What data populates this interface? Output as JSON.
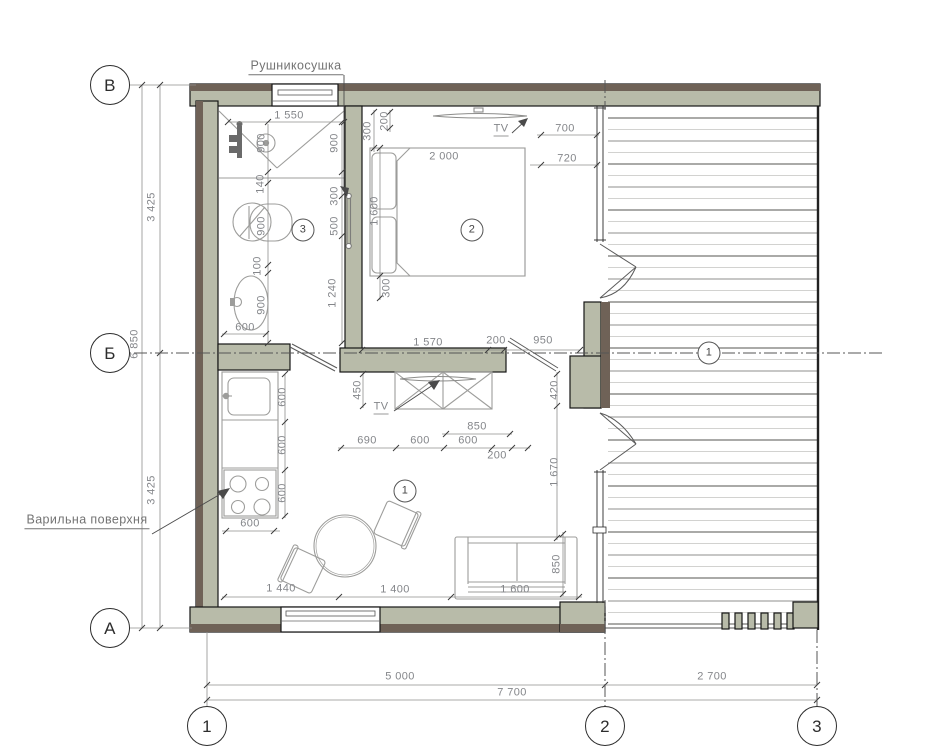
{
  "drawing": {
    "type": "floor-plan",
    "colors": {
      "wall_fill": "#b8bba9",
      "wall_band": "#6f6257",
      "outline": "#161616",
      "furniture_line": "#9d9d9b",
      "dim_text": "#84868a",
      "centerline": "#555555"
    },
    "leader_labels": {
      "towel_dryer": "Рушникосушка",
      "cooktop": "Варильна поверхня"
    },
    "axis_markers_left": [
      "В",
      "Б",
      "А"
    ],
    "axis_markers_bottom": [
      "1",
      "2",
      "3"
    ],
    "room_numbers": [
      "1",
      "2",
      "3"
    ],
    "overall_dimensions": {
      "left_segments": [
        "3 425",
        "3 425"
      ],
      "left_total": "6 850",
      "bottom_segments": [
        "5 000",
        "2 700"
      ],
      "bottom_total": "7 700"
    }
  },
  "annotations": [
    {
      "type": "axis",
      "text": "В",
      "x": 110,
      "y": 85,
      "name": "axis-row-v"
    },
    {
      "type": "axis",
      "text": "Б",
      "x": 110,
      "y": 353,
      "name": "axis-row-b"
    },
    {
      "type": "axis",
      "text": "А",
      "x": 110,
      "y": 628,
      "name": "axis-row-a"
    },
    {
      "type": "axis",
      "text": "1",
      "x": 207,
      "y": 726,
      "name": "axis-col-1"
    },
    {
      "type": "axis",
      "text": "2",
      "x": 605,
      "y": 726,
      "name": "axis-col-2"
    },
    {
      "type": "axis",
      "text": "3",
      "x": 817,
      "y": 726,
      "name": "axis-col-3"
    },
    {
      "type": "room",
      "text": "3",
      "x": 303,
      "y": 230,
      "name": "room-number-3"
    },
    {
      "type": "room",
      "text": "2",
      "x": 472,
      "y": 230,
      "name": "room-number-2"
    },
    {
      "type": "room",
      "text": "1",
      "x": 405,
      "y": 491,
      "name": "room-number-1"
    },
    {
      "type": "room",
      "text": "1",
      "x": 709,
      "y": 353,
      "name": "axis-ref-1"
    },
    {
      "type": "label",
      "text": "Рушникосушка",
      "x": 296,
      "y": 67,
      "name": "label-towel-dryer"
    },
    {
      "type": "label",
      "text": "Варильна поверхня",
      "x": 87,
      "y": 521,
      "name": "label-cooktop"
    },
    {
      "type": "tvlabel",
      "text": "TV",
      "x": 501,
      "y": 130,
      "name": "label-tv-bedroom"
    },
    {
      "type": "tvlabel",
      "text": "TV",
      "x": 381,
      "y": 408,
      "name": "label-tv-living"
    },
    {
      "type": "dim",
      "text": "1 550",
      "x": 289,
      "y": 116
    },
    {
      "type": "dim",
      "text": "600",
      "x": 245,
      "y": 328
    },
    {
      "type": "dim",
      "text": "2 000",
      "x": 444,
      "y": 157
    },
    {
      "type": "dim",
      "text": "700",
      "x": 565,
      "y": 129
    },
    {
      "type": "dim",
      "text": "720",
      "x": 567,
      "y": 159
    },
    {
      "type": "dim",
      "text": "1 570",
      "x": 428,
      "y": 343
    },
    {
      "type": "dim",
      "text": "200",
      "x": 496,
      "y": 341
    },
    {
      "type": "dim",
      "text": "950",
      "x": 543,
      "y": 341
    },
    {
      "type": "dim",
      "text": "850",
      "x": 477,
      "y": 427
    },
    {
      "type": "dim",
      "text": "690",
      "x": 367,
      "y": 441
    },
    {
      "type": "dim",
      "text": "600",
      "x": 420,
      "y": 441
    },
    {
      "type": "dim",
      "text": "600",
      "x": 468,
      "y": 441
    },
    {
      "type": "dim",
      "text": "200",
      "x": 497,
      "y": 456
    },
    {
      "type": "dim",
      "text": "600",
      "x": 250,
      "y": 524
    },
    {
      "type": "dim",
      "text": "1 440",
      "x": 281,
      "y": 589
    },
    {
      "type": "dim",
      "text": "1 400",
      "x": 395,
      "y": 590
    },
    {
      "type": "dim",
      "text": "1 600",
      "x": 515,
      "y": 590
    },
    {
      "type": "dim",
      "text": "5 000",
      "x": 400,
      "y": 677
    },
    {
      "type": "dim",
      "text": "2 700",
      "x": 712,
      "y": 677
    },
    {
      "type": "dim",
      "text": "7 700",
      "x": 512,
      "y": 693
    },
    {
      "type": "dimv",
      "text": "900",
      "x": 262,
      "y": 143
    },
    {
      "type": "dimv",
      "text": "900",
      "x": 335,
      "y": 143
    },
    {
      "type": "dimv",
      "text": "140",
      "x": 261,
      "y": 184
    },
    {
      "type": "dimv",
      "text": "300",
      "x": 335,
      "y": 196
    },
    {
      "type": "dimv",
      "text": "500",
      "x": 335,
      "y": 226
    },
    {
      "type": "dimv",
      "text": "900",
      "x": 262,
      "y": 226
    },
    {
      "type": "dimv",
      "text": "100",
      "x": 258,
      "y": 266
    },
    {
      "type": "dimv",
      "text": "900",
      "x": 262,
      "y": 305
    },
    {
      "type": "dimv",
      "text": "1 240",
      "x": 333,
      "y": 293
    },
    {
      "type": "dimv",
      "text": "300",
      "x": 368,
      "y": 131
    },
    {
      "type": "dimv",
      "text": "200",
      "x": 385,
      "y": 121
    },
    {
      "type": "dimv",
      "text": "1 600",
      "x": 375,
      "y": 211
    },
    {
      "type": "dimv",
      "text": "300",
      "x": 387,
      "y": 288
    },
    {
      "type": "dimv",
      "text": "450",
      "x": 358,
      "y": 390
    },
    {
      "type": "dimv",
      "text": "420",
      "x": 555,
      "y": 390
    },
    {
      "type": "dimv",
      "text": "1 670",
      "x": 555,
      "y": 472
    },
    {
      "type": "dimv",
      "text": "600",
      "x": 283,
      "y": 397
    },
    {
      "type": "dimv",
      "text": "600",
      "x": 283,
      "y": 445
    },
    {
      "type": "dimv",
      "text": "600",
      "x": 283,
      "y": 493
    },
    {
      "type": "dimv",
      "text": "850",
      "x": 557,
      "y": 564
    },
    {
      "type": "dimv",
      "text": "3 425",
      "x": 152,
      "y": 207
    },
    {
      "type": "dimv",
      "text": "6 850",
      "x": 135,
      "y": 344
    },
    {
      "type": "dimv",
      "text": "3 425",
      "x": 152,
      "y": 490
    }
  ]
}
